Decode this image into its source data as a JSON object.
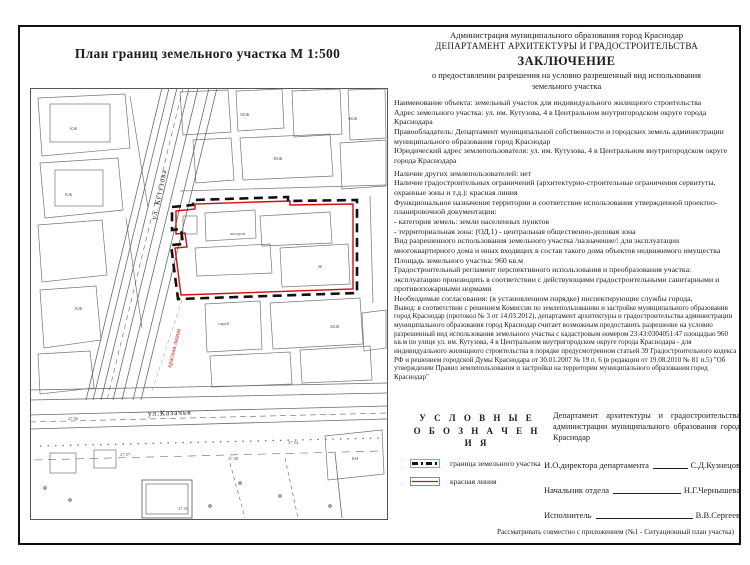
{
  "page": {
    "title_left": "План границ земельного участка М 1:500",
    "footer": "Рассматривать совместно с приложением (№1 - Ситуационный план участка)"
  },
  "header": {
    "line1": "Администрация муниципального образования город Краснодар",
    "line2": "ДЕПАРТАМЕНТ АРХИТЕКТУРЫ И ГРАДОСТРОИТЕЛЬСТВА",
    "title": "ЗАКЛЮЧЕНИЕ",
    "subtitle1": "о предоставлении разрешения на условно разрешенный вид использования",
    "subtitle2": "земельного участка"
  },
  "body": {
    "paragraphs": [
      "Наименование объекта: земельный участок для индивидуального жилищного строительства",
      "Адрес земельного участка: ул. им. Кутузова, 4 в Центральном внутригородском округе города Краснодара",
      "Правообладатель:  Департамент муниципальной собственности и городских земель администрации муниципального образования город Краснодар",
      "Юридический адрес землепользователя:  ул. им. Кутузова, 4 в Центральном внутригородском округе города Краснодара",
      "Наличие других землепользователей: нет",
      "Наличие градостроительных ограничений (архитектурно-строительные ограничения сервитуты, охранные зоны и т.д.): красная линия",
      "Функциональное назначение территории и соответствие использования утвержденной проектно-планировочной документации:",
      "- категория земель: земли населенных пунктов",
      "- территориальная зона: (ОД.1) - центральная общественно-деловая зона",
      "Вид разрешенного использования земельного участка /назначение/: для эксплуатации многоквартирного дома и иных входящих в состав такого дома объектов недвижимого имущества",
      "Площадь земельного участка: 960 кв.м",
      "Градостроительный регламент перспективного использования и преобразования участка: эксплуатацию производить в соответствии с действующими градостроительными санитарными и противопожарными нормами",
      "Необходимые согласования: (в установленном порядке) инспектирующие службы города,"
    ],
    "conclusion": "Вывод: в соответствии с решением Комиссии по землепользованию и застройке муниципального образования город Краснодар (протокол № 3 от 14.03.2012), департамент архитектуры и градостроительства администрации муниципального образования город Краснодар считает возможным предоставить разрешение на условно разрешенный вид использования земельного участка с кадастровым номером 23:43:0304051:47 площадью 960 кв.м по улице ул. им. Кутузова, 4 в Центральном внутригородском округе города Краснодара - для индивидуального жилищного строительства в порядке предусмотренном статьей 39 Градостроительного кодекса  РФ и решением городской Думы Краснодара от 30.01.2007 № 19 п. 6 (в редакции от 19.08.2010 № 81 п.5) \"Об утверждении Правил землепользования и застройки на территории муниципального образования город Краснодар\""
  },
  "legend": {
    "title1": "У С Л О В Н Ы Е",
    "title2": "О Б О З Н А Ч Е Н И Я",
    "item1": "граница земельного участка",
    "item2": "красная линия"
  },
  "signatures": {
    "org": "Департамент архитектуры и градостроительства администрации муниципального образования город Краснодар",
    "rows": [
      {
        "label": "И.О.директора департамента",
        "name": "С.Д.Кузнецов"
      },
      {
        "label": "Начальник отдела",
        "name": "Н.Г.Чернышева"
      },
      {
        "label": "Исполнитель",
        "name": "В.В.Сергеев"
      }
    ]
  },
  "map": {
    "street_kutuzova": "ул. Кутузова",
    "street_kazachya": "ул.Казачья",
    "red_line_label": "красная линия",
    "annotations": [
      "КЖ",
      "5КЖ",
      "4КЖ",
      "КЖ",
      "жилдом",
      "Ж",
      "27.57",
      "27.58",
      "27.54",
      "27.50",
      "КН",
      "ЗКЖ",
      "27.56",
      "сарай",
      "КЖ",
      "2КЖ"
    ]
  },
  "colors": {
    "red": "#cc1111",
    "ink": "#1c1c1c",
    "map_line": "#707070"
  }
}
